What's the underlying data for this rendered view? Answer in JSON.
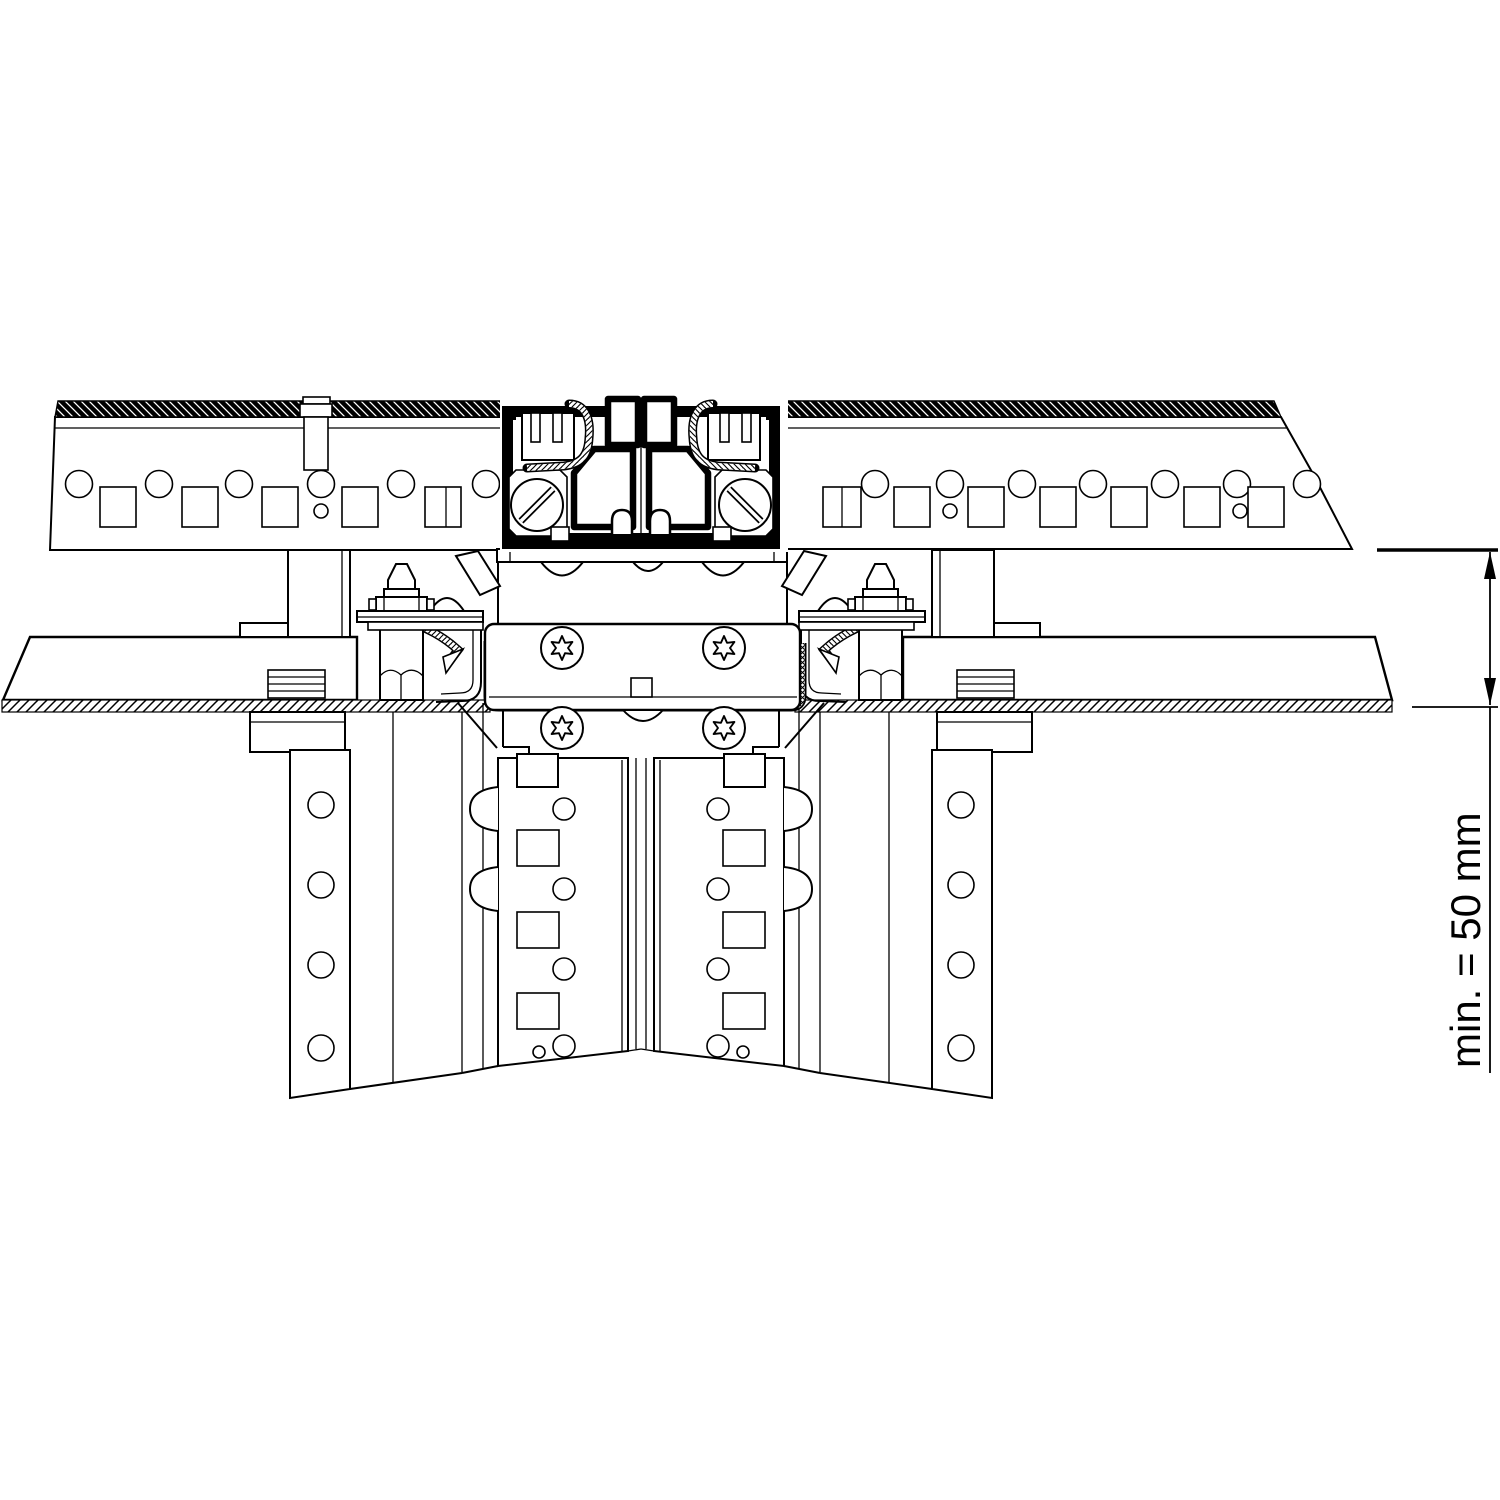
{
  "document": {
    "kind": "technical-section-drawing",
    "description": "Black-and-white CAD cross-section of a panel clamp joint: hole-punched top rail with glazing clamps in a dark extruded profile, a screwed connector bracket with torx screws and hex bolts, horizontal sheet panels with hatched edges, and twin perforated support channels below.",
    "background_color": "#ffffff",
    "line_color": "#000000"
  },
  "dimension": {
    "label": "min. = 50 mm"
  }
}
